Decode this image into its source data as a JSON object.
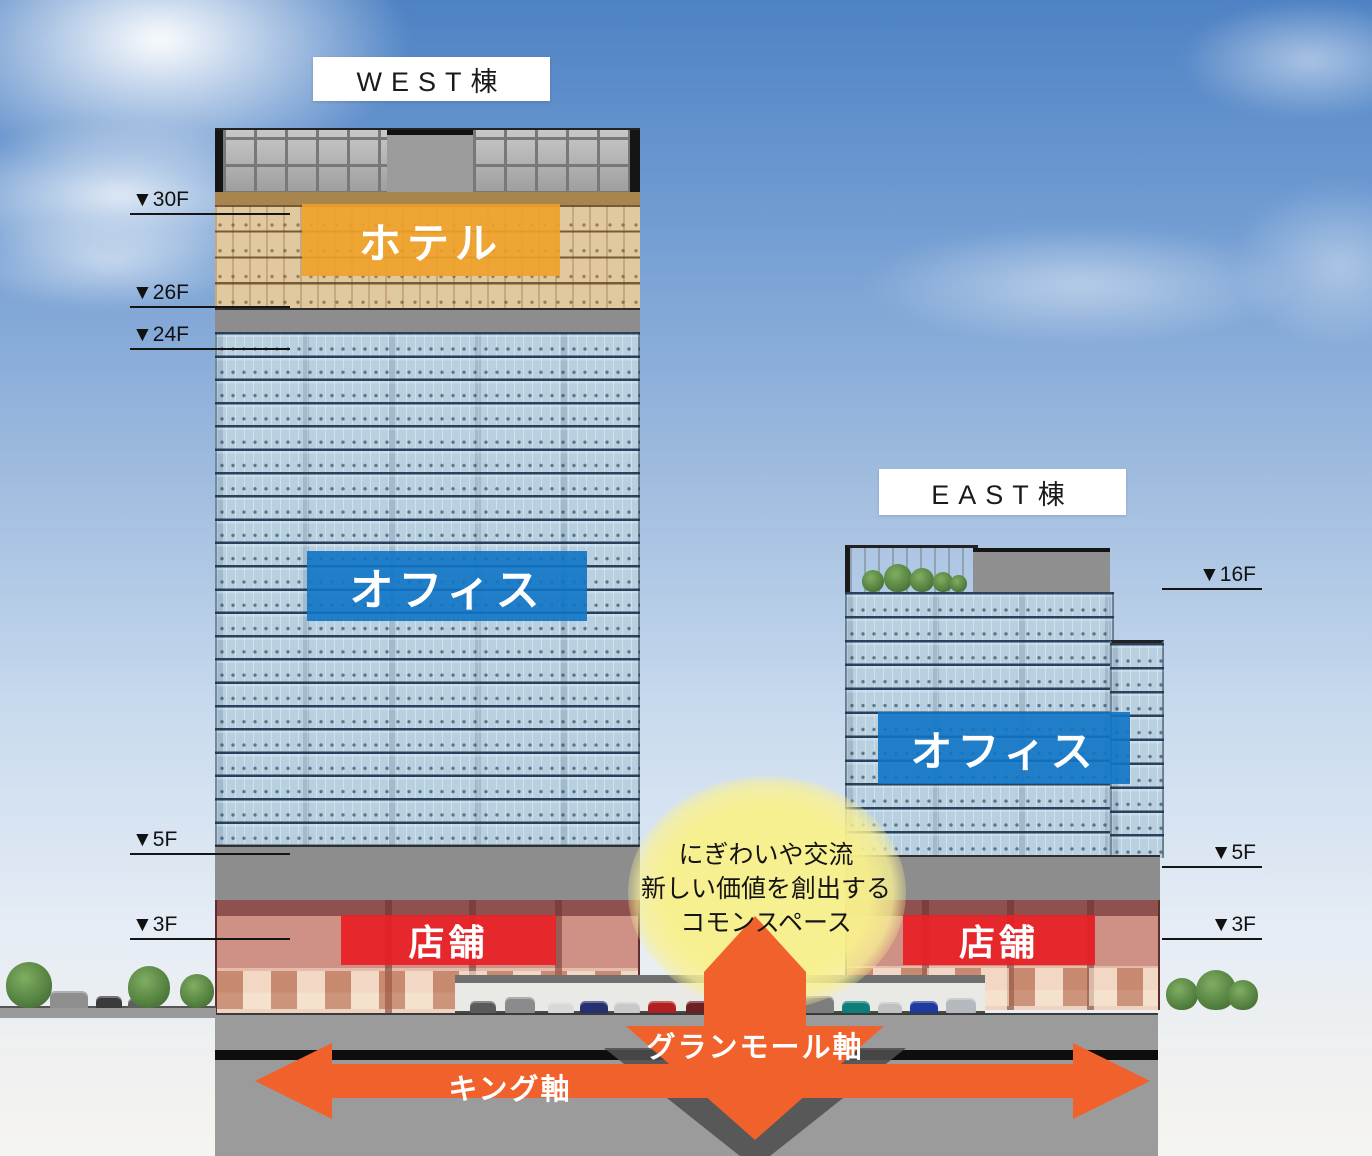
{
  "diagram_title": "再開発ビル断面図",
  "buildings": {
    "west": {
      "name_label": "WEST棟",
      "zones": {
        "hotel": "ホテル",
        "office": "オフィス",
        "retail": "店舗"
      },
      "floor_markers": [
        {
          "label": "▼30F",
          "y": 215
        },
        {
          "label": "▼26F",
          "y": 308
        },
        {
          "label": "▼24F",
          "y": 350
        },
        {
          "label": "▼5F",
          "y": 855
        },
        {
          "label": "▼3F",
          "y": 940
        }
      ]
    },
    "east": {
      "name_label": "EAST棟",
      "zones": {
        "office": "オフィス",
        "retail": "店舗"
      },
      "floor_markers": [
        {
          "label": "▼16F",
          "y": 590
        },
        {
          "label": "▼5F",
          "y": 868
        },
        {
          "label": "▼3F",
          "y": 940
        }
      ]
    }
  },
  "annotations": {
    "commons": {
      "lines": [
        "にぎわいや交流",
        "新しい価値を創出する",
        "コモンスペース"
      ]
    },
    "axes": {
      "granmall": "グランモール軸",
      "king": "キング軸"
    }
  },
  "colors": {
    "hotel_orange": "rgba(240,161,40,0.9)",
    "office_blue": "rgba(16,116,198,0.9)",
    "retail_red": "rgba(231,31,37,0.93)",
    "axis_orange": "#F1612B",
    "axis_shadow_gray": "#4F4F4F",
    "commons_yellow": "#F8F08C",
    "sky_blue_top": "#4E82C4"
  },
  "scene": {
    "road_vehicles": [
      {
        "x": 470,
        "w": 26,
        "h": 12,
        "color": "#5a5a5a"
      },
      {
        "x": 505,
        "w": 30,
        "h": 16,
        "color": "#8b8b8b"
      },
      {
        "x": 548,
        "w": 26,
        "h": 11,
        "color": "#d8d8d8"
      },
      {
        "x": 580,
        "w": 28,
        "h": 12,
        "color": "#27306e"
      },
      {
        "x": 614,
        "w": 26,
        "h": 11,
        "color": "#c9c9c9"
      },
      {
        "x": 648,
        "w": 28,
        "h": 12,
        "color": "#b02020"
      },
      {
        "x": 686,
        "w": 26,
        "h": 12,
        "color": "#6e1f24"
      },
      {
        "x": 800,
        "w": 34,
        "h": 17,
        "color": "#7d7d7d"
      },
      {
        "x": 842,
        "w": 28,
        "h": 12,
        "color": "#0f7d78"
      },
      {
        "x": 878,
        "w": 24,
        "h": 11,
        "color": "#c0c0c0"
      },
      {
        "x": 910,
        "w": 28,
        "h": 12,
        "color": "#1f3a9e"
      },
      {
        "x": 946,
        "w": 30,
        "h": 15,
        "color": "#b5b9bd"
      }
    ],
    "street_vehicles": [
      {
        "x": 50,
        "w": 38,
        "h": 17,
        "color": "#8f8f8f"
      },
      {
        "x": 96,
        "w": 26,
        "h": 12,
        "color": "#3a3a3a"
      },
      {
        "x": 128,
        "w": 22,
        "h": 10,
        "color": "#5f5f5f"
      }
    ],
    "ground_trees": [
      {
        "x": 6,
        "size": 46,
        "bottom": 1008
      },
      {
        "x": 128,
        "size": 42,
        "bottom": 1008
      },
      {
        "x": 180,
        "size": 34,
        "bottom": 1008
      },
      {
        "x": 1166,
        "size": 32,
        "bottom": 1010
      },
      {
        "x": 1196,
        "size": 40,
        "bottom": 1010
      },
      {
        "x": 1228,
        "size": 30,
        "bottom": 1010
      }
    ],
    "roof_trees": [
      {
        "x": 862,
        "size": 22,
        "bottom": 592
      },
      {
        "x": 884,
        "size": 28,
        "bottom": 592
      },
      {
        "x": 910,
        "size": 24,
        "bottom": 592
      },
      {
        "x": 933,
        "size": 20,
        "bottom": 592
      },
      {
        "x": 950,
        "size": 17,
        "bottom": 592
      }
    ]
  }
}
